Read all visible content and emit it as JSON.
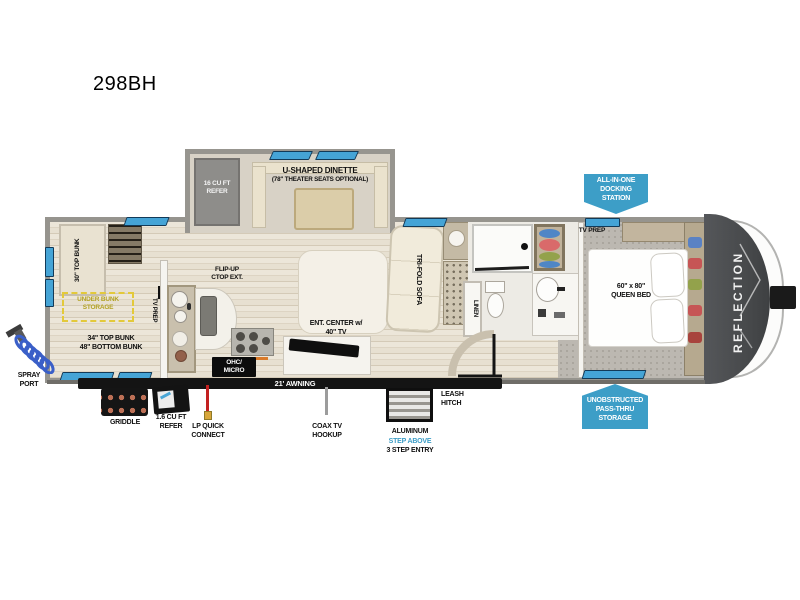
{
  "title": "298BH",
  "colors": {
    "badge_blue": "#3d9ec7",
    "window_blue": "#45a4d6",
    "under_bunk_yellow": "#e3c93a",
    "lp_red": "#c32121",
    "step_above_blue": "#3d9dc6",
    "front_cap_gray": "#4a4c4e",
    "wall_gray": "#96948e"
  },
  "interior": {
    "refer": "16 CU FT\nREFER",
    "dinette": "U-SHAPED DINETTE",
    "dinette_sub": "(78\" THEATER SEATS OPTIONAL)",
    "bunk30": "30\" TOP BUNK",
    "under_bunk": "UNDER BUNK\nSTORAGE",
    "bunk3448": "34\" TOP BUNK\n48\" BOTTOM BUNK",
    "tv_prep_bunk": "TV PREP",
    "flip_up": "FLIP-UP\nCTOP EXT.",
    "ohc": "OHC/\nMICRO",
    "ent_center": "ENT. CENTER w/\n40\" TV",
    "sofa": "TRI-FOLD SOFA",
    "linen": "LINEN",
    "tv_prep_bed": "TV PREP",
    "queen": "60\" x 80\"\nQUEEN BED"
  },
  "exterior": {
    "reflection": "REFLECTION",
    "docking": "ALL-IN-ONE\nDOCKING\nSTATION",
    "passthru": "UNOBSTRUCTED\nPASS-THRU\nSTORAGE",
    "awning": "21' AWNING",
    "spray": "SPRAY\nPORT",
    "griddle": "GRIDDLE",
    "refer_small": "1.6 CU FT\nREFER",
    "lp": "LP QUICK\nCONNECT",
    "coax": "COAX TV\nHOOKUP",
    "step1": "ALUMINUM",
    "step2": "STEP ABOVE",
    "step3": "3 STEP ENTRY",
    "leash": "LEASH\nHITCH"
  }
}
